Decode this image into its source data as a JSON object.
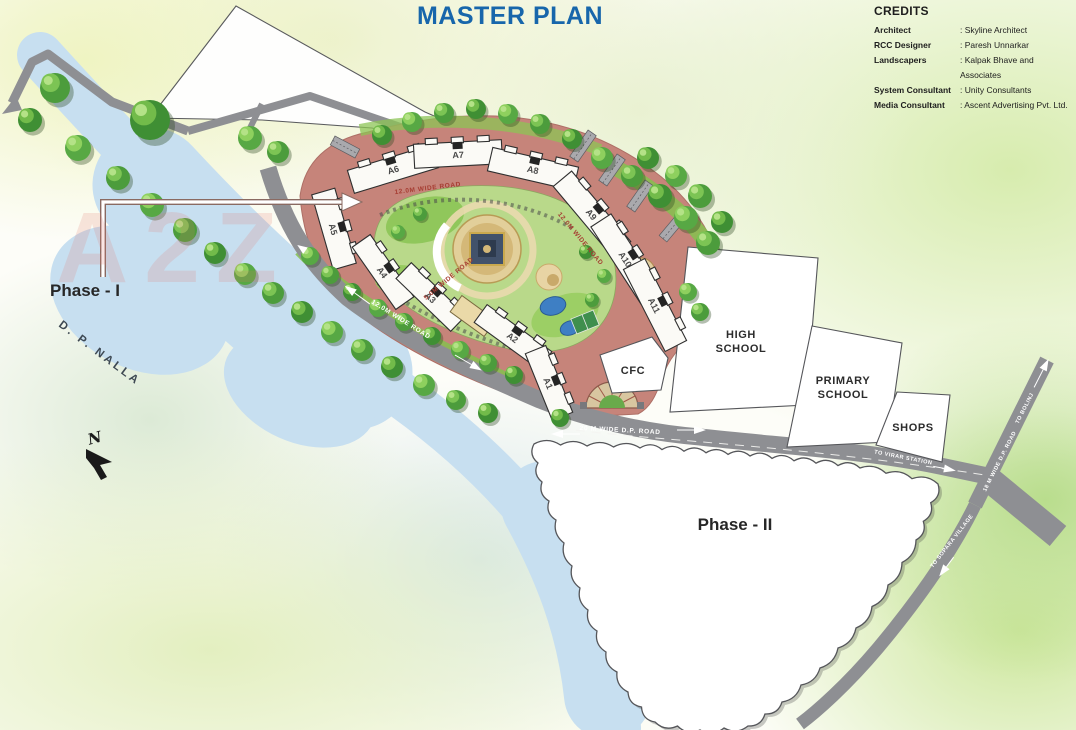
{
  "title": "MASTER PLAN",
  "credits": {
    "heading": "CREDITS",
    "rows": [
      {
        "label": "Architect",
        "value": ": Skyline Architect"
      },
      {
        "label": "RCC Designer",
        "value": ": Paresh Unnarkar"
      },
      {
        "label": "Landscapers",
        "value": ": Kalpak Bhave and Associates"
      },
      {
        "label": "System Consultant",
        "value": ": Unity Consultants"
      },
      {
        "label": "Media Consultant",
        "value": ": Ascent Advertising Pvt. Ltd."
      }
    ]
  },
  "map": {
    "watermark": "A2Z",
    "compass_label": "N",
    "phase1_label": "Phase - I",
    "phase2_label": "Phase - II",
    "nalla_label": "D. P. NALLA",
    "buildings": [
      "A1",
      "A2",
      "A3",
      "A4",
      "A5",
      "A6",
      "A7",
      "A8",
      "A9",
      "A10",
      "A11"
    ],
    "plots": {
      "cfc": "CFC",
      "high_school": [
        "HIGH",
        "SCHOOL"
      ],
      "primary_school": [
        "PRIMARY",
        "SCHOOL"
      ],
      "shops": "SHOPS"
    },
    "roads": {
      "ring_top": "12.0M WIDE ROAD",
      "ring_ne": "12.0M WIDE ROAD",
      "inner": "5.0M WIDE ROAD",
      "southwest": "12.0M WIDE ROAD",
      "main": "20 M WIDE D.P. ROAD",
      "virar": "TO VIRAR STATION",
      "bolinj": "TO BOLINJ",
      "east_18m": "18 M WIDE D.P. ROAD",
      "sopara": "TO SOPARA VILLAGE"
    }
  },
  "colors": {
    "title_blue": "#1766ab",
    "development_salmon": "#c6847a",
    "water_blue": "#c7dff0",
    "road_gray": "#8e8f93",
    "park_green": "#b9d98a",
    "label_red": "#a63d32"
  }
}
